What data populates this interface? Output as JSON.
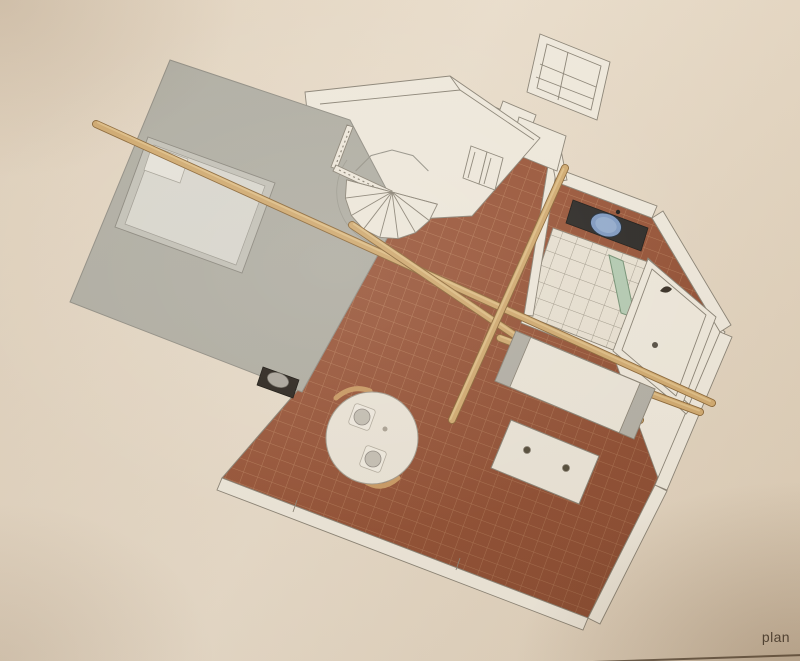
{
  "caption": {
    "text": "plan"
  },
  "palette": {
    "paper": "#eadfce",
    "tile": "#9e5a3e",
    "tile_line": "#c68d6a",
    "mezzanine": "#b5b4aa",
    "bed_frame": "#c9c8bf",
    "mattress": "#dfded6",
    "wall_fill": "#f4efe3",
    "wall_line": "#8e887b",
    "beam": "#d6b076",
    "beam_edge": "#8f6c3d",
    "bath_tile": "#eee8da",
    "bath_tile_line": "#a49e90",
    "counter": "#2f2e2c",
    "sink": "#83a0c9",
    "screen": "#b9d2ba",
    "stove": "#2c2722",
    "wood_chair": "#cf9f68",
    "table_top": "#f1ece0",
    "caption_text": "#4e463c",
    "caption_line": "#5a4d3e"
  },
  "plan": {
    "rooms": [
      {
        "name": "mezzanine-bedroom"
      },
      {
        "name": "living-room"
      },
      {
        "name": "hallway"
      },
      {
        "name": "bathroom"
      }
    ],
    "furniture": [
      "double-bed",
      "spiral-staircase",
      "wood-stove",
      "round-dining-table",
      "dining-chairs",
      "place-settings",
      "sofa",
      "coffee-table",
      "vanity-with-washbasin",
      "bathtub",
      "shower-screen",
      "shelving-unit",
      "entry-door",
      "closet-doors",
      "wooden-beams"
    ]
  }
}
